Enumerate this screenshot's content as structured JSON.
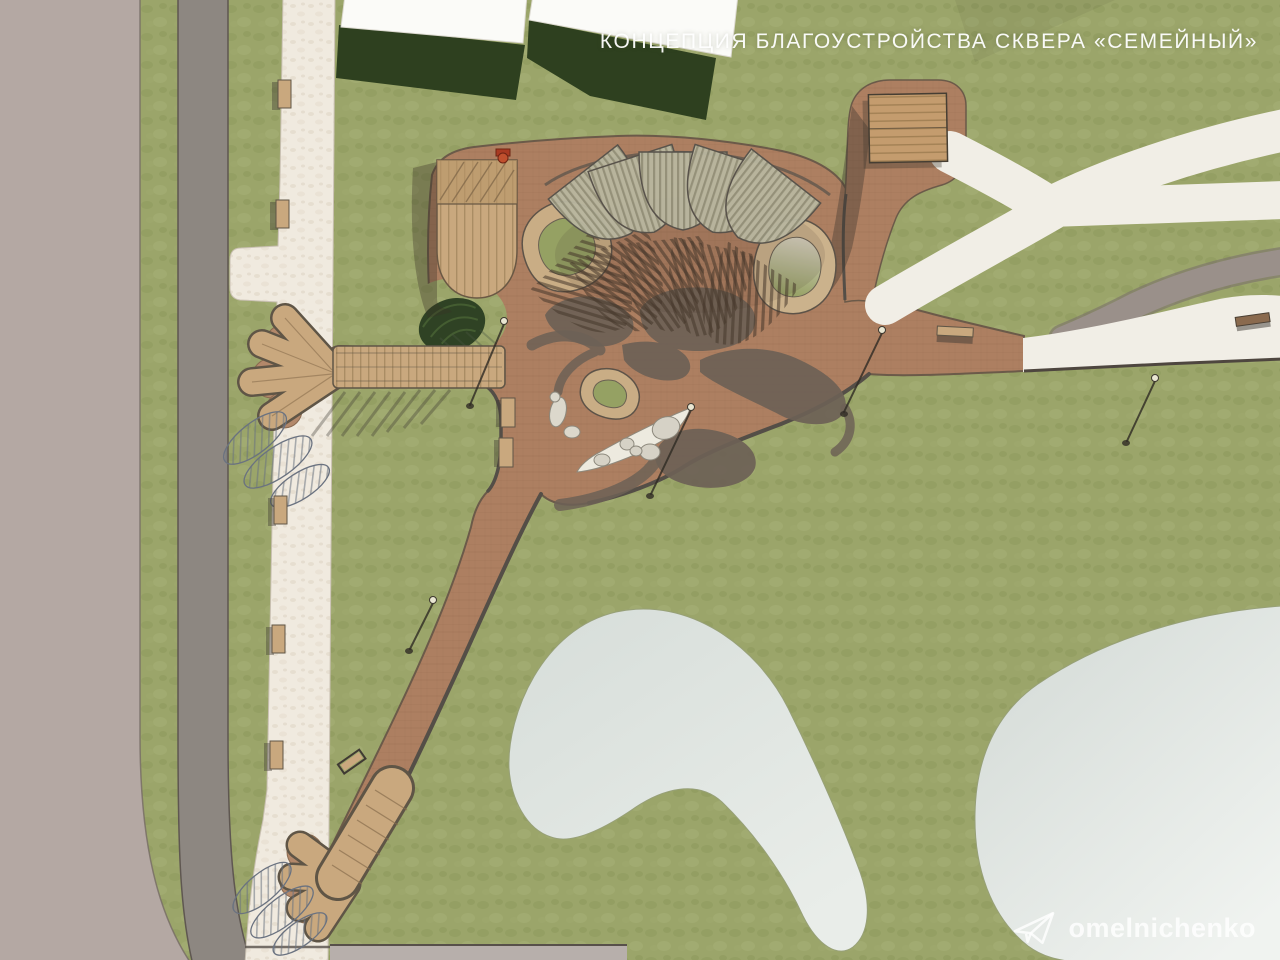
{
  "header": {
    "title": "КОНЦЕПЦИЯ БЛАГОУСТРОЙСТВА СКВЕРА «СЕМЕЙНЫЙ»"
  },
  "watermark": {
    "label": "omelnichenko",
    "icon": "paper-plane-icon"
  },
  "palette": {
    "lawn": "#9ba56a",
    "lawn_shadow": "#2e401f",
    "plaza_brown": "#ad7f61",
    "plaza_blob_dark": "#6d6156",
    "wood_deck": "#c9a87e",
    "wood_roof": "#c49c6e",
    "sidewalk_white": "#f0eadf",
    "path_white": "#f1eee6",
    "road_gray": "#8d8781",
    "paved_mauve": "#b4a8a3",
    "pond_gray": "#dde3de",
    "building_white": "#fbfbf8",
    "curb_dark": "#544e47",
    "canopy_slat": "#b9b7a0",
    "accent_red": "#a93a22",
    "title_color": "#ffffff"
  }
}
